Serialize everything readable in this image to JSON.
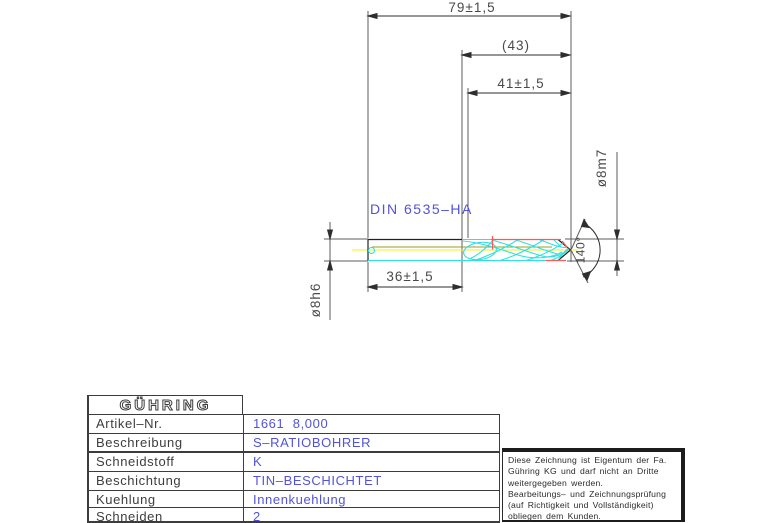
{
  "drawing": {
    "dims": {
      "overall_length": "79±1,5",
      "length_ref": "(43)",
      "flute_length": "41±1,5",
      "clamp_length": "36±1,5",
      "shank_diameter": "ø8h6",
      "cutting_diameter": "ø8m7",
      "point_angle": "140°",
      "shank_standard": "DIN 6535–HA"
    },
    "colors": {
      "flute_cyan": "#2fe0e4",
      "highlight_red": "#ff5a52",
      "centerline_yellow": "#f2f21f",
      "coolant_olive": "#9c9c22",
      "label_blue": "#5353d8",
      "line_dark": "#2e2e2e"
    }
  },
  "table": {
    "brand": "GÜHRING",
    "rows": [
      {
        "label": "Artikel–Nr.",
        "value": "1661  8,000"
      },
      {
        "label": "Beschreibung",
        "value": "S–RATIOBOHRER"
      },
      {
        "label": "Schneidstoff",
        "value": "K"
      },
      {
        "label": "Beschichtung",
        "value": "TIN–BESCHICHTET"
      },
      {
        "label": "Kuehlung",
        "value": "Innenkuehlung"
      },
      {
        "label": "Schneiden",
        "value": "2"
      }
    ]
  },
  "note": {
    "lines": [
      "Diese Zeichnung ist Eigentum der Fa.",
      "Gühring KG und darf nicht an Dritte",
      "weitergegeben werden.",
      "Bearbeitungs– und Zeichnungsprüfung",
      "(auf Richtigkeit und Vollständigkeit)",
      "obliegen dem Kunden."
    ]
  }
}
